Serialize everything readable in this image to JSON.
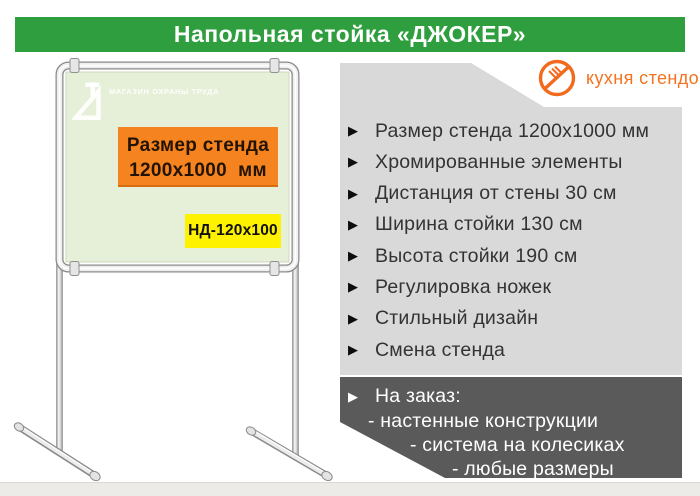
{
  "header": {
    "title": "Напольная стойка «ДЖОКЕР»"
  },
  "brand": {
    "name": "кухня стендов",
    "icon": "no-kitchen-icon",
    "color": "#f4731f"
  },
  "icons": {
    "bullet": "▶"
  },
  "stand": {
    "board_logo_text": "МАГАЗИН ОХРАНЫ ТРУДА",
    "size_plate": {
      "line1": "Размер стенда",
      "line2": "1200х1000  мм"
    },
    "model_plate": "НД-120х100"
  },
  "features": [
    "Размер стенда 1200х1000 мм",
    "Хромированные элементы",
    "Дистанция от стены 30 см",
    "Ширина стойки 130 см",
    "Высота стойки 190 см",
    "Регулировка ножек",
    "Стильный дизайн",
    "Смена стенда"
  ],
  "custom_order": {
    "title": "На заказ:",
    "items": [
      "- настенные конструкции",
      "- система на колесиках",
      "- любые размеры"
    ]
  },
  "colors": {
    "header_green": "#2f9e3e",
    "brand_orange": "#f4731f",
    "panel_gray": "#d9d9d9",
    "dark_box_gray": "#5a5a5a",
    "plate_orange": "#f5831f",
    "plate_yellow": "#fff200",
    "board_green": "#e6efd8"
  }
}
